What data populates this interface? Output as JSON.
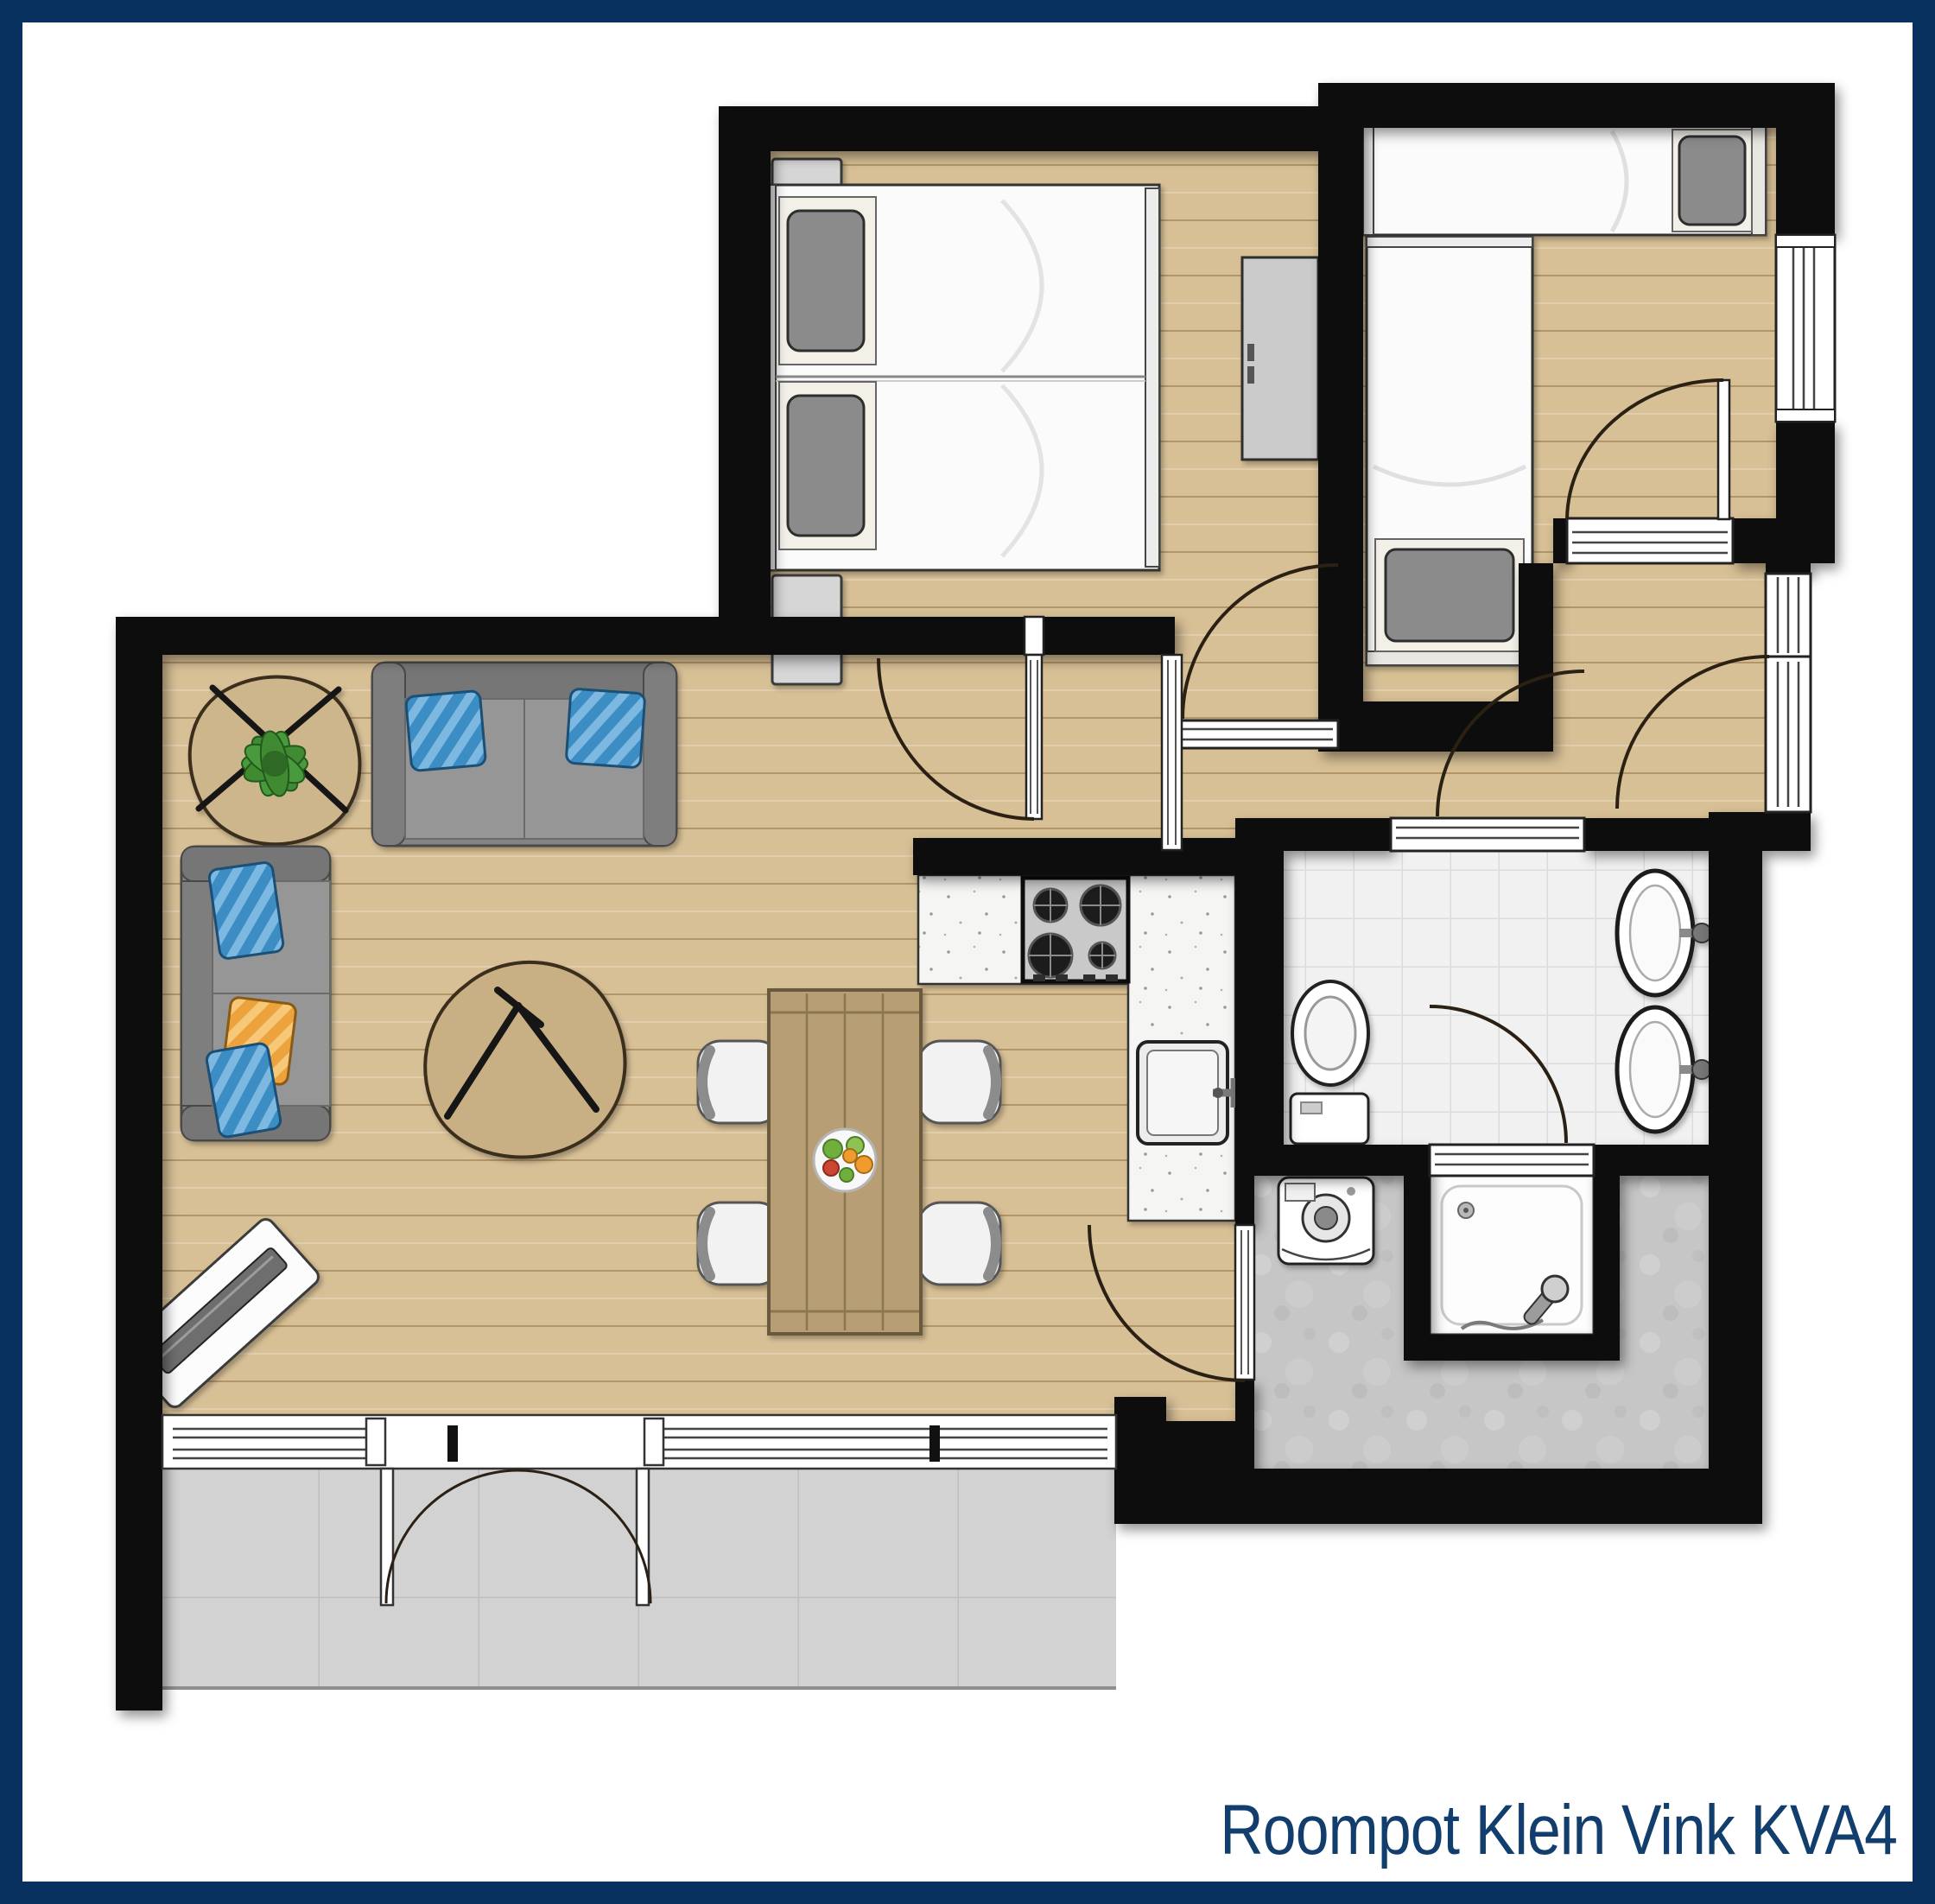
{
  "title": "Roompot Klein Vink KVA4",
  "colors": {
    "frame_navy": "#083160",
    "title_navy": "#123e6d",
    "wall_black": "#0a0a0a",
    "wood_floor": "#d8c096",
    "terrace_gray": "#d2d2d2",
    "bathroom_tile": "#f1f1f1",
    "utility_floor": "#c6c6c6",
    "kitchen_counter": "#f5f5f3",
    "sofa_gray": "#8f8f8f",
    "pillow_blue": "#3e8dc5",
    "pillow_orange": "#eca33c",
    "plant_green": "#3f8a33",
    "table_wood": "#b89e74"
  },
  "plan": {
    "type": "holiday-home floor plan, top-down",
    "rooms": [
      {
        "name": "living-dining-room",
        "floor": "wood",
        "items": [
          "three-seat-sofa",
          "two-seat-sofa",
          "blue-pillows",
          "orange-pillow",
          "plant-side-table",
          "coffee-table",
          "tv-cabinet",
          "dining-table",
          "dining-chairs-x4",
          "fruit-bowl"
        ]
      },
      {
        "name": "kitchen",
        "floor": "wood",
        "items": [
          "l-shaped-counter",
          "gas-hob-4-burners",
          "kitchen-sink"
        ]
      },
      {
        "name": "bedroom-1",
        "floor": "wood",
        "items": [
          "double-bed",
          "gray-pillows-x2",
          "nightstand-x2",
          "wardrobe"
        ]
      },
      {
        "name": "bedroom-2",
        "floor": "wood",
        "items": [
          "single-bed-horizontal",
          "single-bed-vertical"
        ]
      },
      {
        "name": "hallway",
        "floor": "wood",
        "items": [
          "entrance-door",
          "window"
        ]
      },
      {
        "name": "bathroom",
        "floor": "white-tiles",
        "items": [
          "toilet",
          "washbasin-x2",
          "shower-door"
        ]
      },
      {
        "name": "utility-room",
        "floor": "gray-concrete",
        "items": [
          "washing-machine",
          "shower-cabin"
        ]
      },
      {
        "name": "terrace",
        "floor": "gray-tiles",
        "items": [
          "french-double-doors",
          "window-wall"
        ]
      }
    ]
  }
}
